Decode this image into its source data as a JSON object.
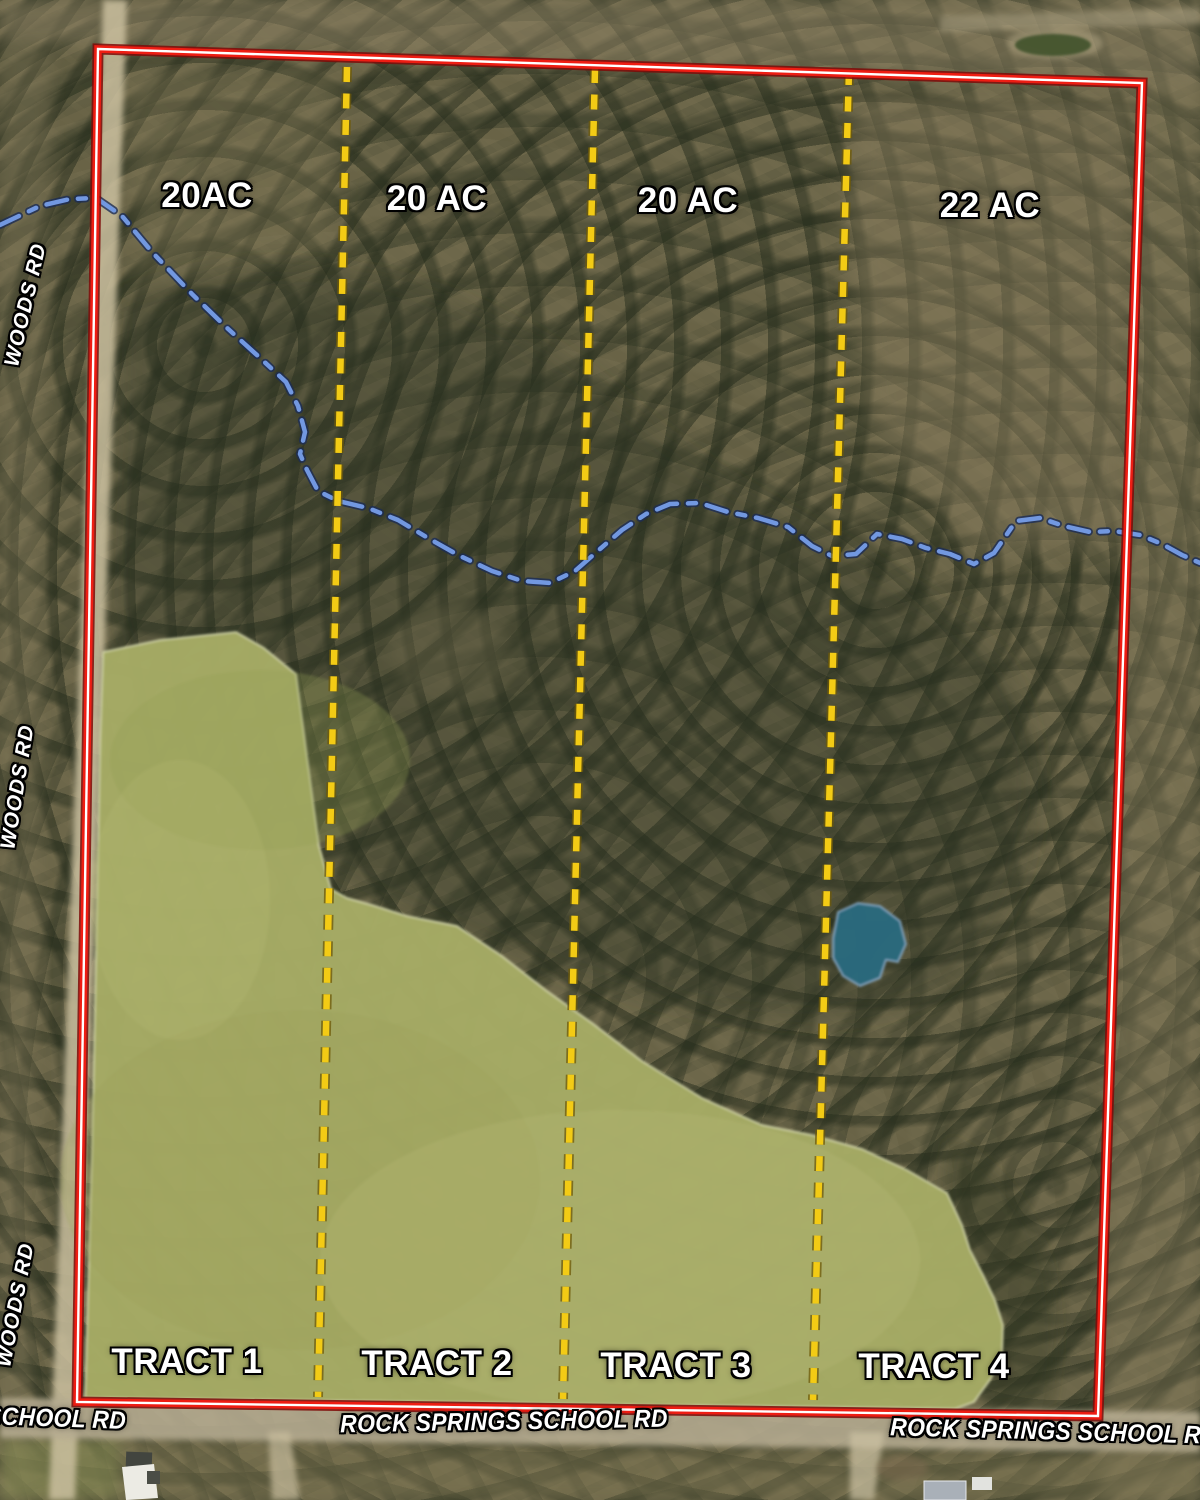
{
  "map_labels": {
    "acreage": [
      "20AC",
      "20 AC",
      "20 AC",
      "22 AC"
    ],
    "tracts": [
      "TRACT 1",
      "TRACT 2",
      "TRACT 3",
      "TRACT 4"
    ],
    "roads": {
      "woods_rd_top": "WOODS RD",
      "woods_rd_middle": "WOODS RD",
      "woods_rd_bottom": "WOODS RD",
      "school_rd_left": "SCHOOL RD",
      "school_rd_center": "ROCK SPRINGS SCHOOL RD",
      "school_rd_right": "ROCK SPRINGS SCHOOL RD"
    }
  },
  "features": {
    "boundary_color": "#ee1d13",
    "divider_color": "#f3cb15",
    "creek_color": "#7298e0",
    "pond_color": "#2b6b7e",
    "pasture_color": "#a7ac66"
  }
}
